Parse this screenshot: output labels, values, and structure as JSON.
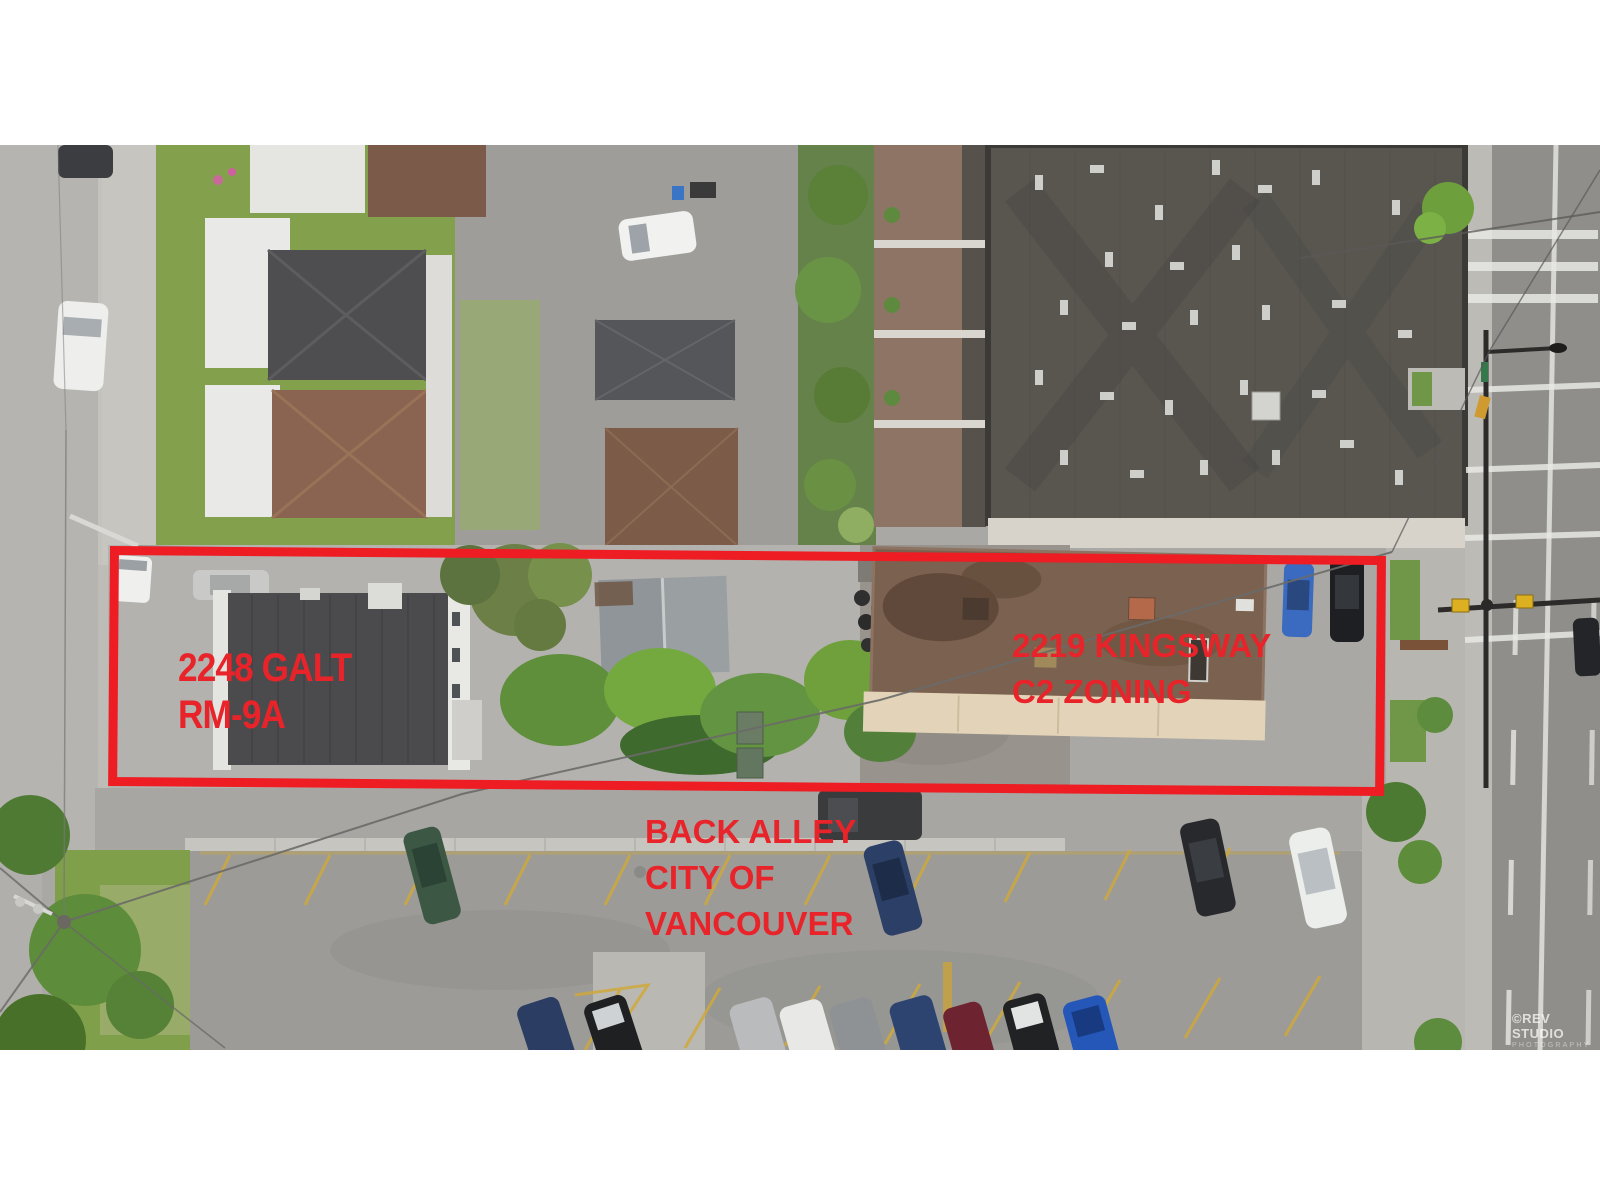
{
  "page": {
    "background_color": "#ffffff",
    "photo_top_px": 145,
    "photo_height_px": 905
  },
  "annotations": {
    "text_color": "#e8232a",
    "box_color": "#ee1c23",
    "boundary_box": {
      "purpose": "red outline around the two subject lots"
    },
    "labels": [
      {
        "id": "lot-left",
        "lines": [
          "2248 GALT",
          "RM-9A"
        ]
      },
      {
        "id": "lot-right",
        "lines": [
          "2219 KINGSWAY",
          "C2 ZONING"
        ]
      },
      {
        "id": "alley",
        "lines": [
          "BACK ALLEY",
          "CITY OF",
          "VANCOUVER"
        ]
      }
    ]
  },
  "watermark": {
    "line1": "©REV STUDIO",
    "line2": "PHOTOGRAPHY"
  },
  "scene": {
    "description": "Aerial drone photo straight down on a Vancouver city block: residential houses and lawns top-left, large dark commercial flat roof top-right, Kingsway road with lane markings on the right, the two subject properties (2248 Galt and 2219 Kingsway) outlined in red across the middle, and a back alley with an angled parking lot full of cars below."
  }
}
